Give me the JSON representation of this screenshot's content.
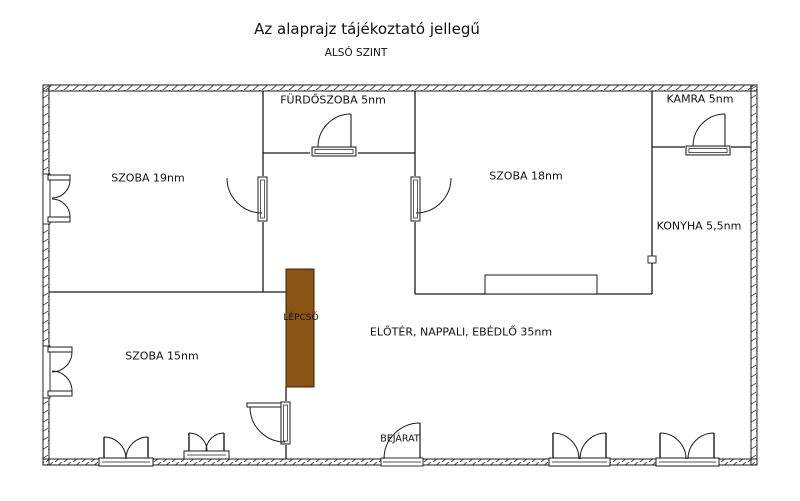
{
  "title": "Az alaprajz tájékoztató jellegű",
  "subtitle": "ALSÓ SZINT",
  "colors": {
    "stairs": "#8a5415",
    "line": "#1b1b1b",
    "background": "#ffffff"
  },
  "rooms": [
    {
      "id": "szoba-19",
      "label": "SZOBA 19nm"
    },
    {
      "id": "furdoszoba",
      "label": "FÜRDŐSZOBA 5nm"
    },
    {
      "id": "kamra",
      "label": "KAMRA 5nm"
    },
    {
      "id": "szoba-18",
      "label": "SZOBA 18nm"
    },
    {
      "id": "konyha",
      "label": "KONYHA 5,5nm"
    },
    {
      "id": "szoba-15",
      "label": "SZOBA 15nm"
    },
    {
      "id": "eloter",
      "label": "ELŐTÉR, NAPPALI, EBÉDLŐ 35nm"
    },
    {
      "id": "lepcso",
      "label": "LÉPCSŐ"
    },
    {
      "id": "bejarat",
      "label": "BEJÁRAT"
    }
  ]
}
